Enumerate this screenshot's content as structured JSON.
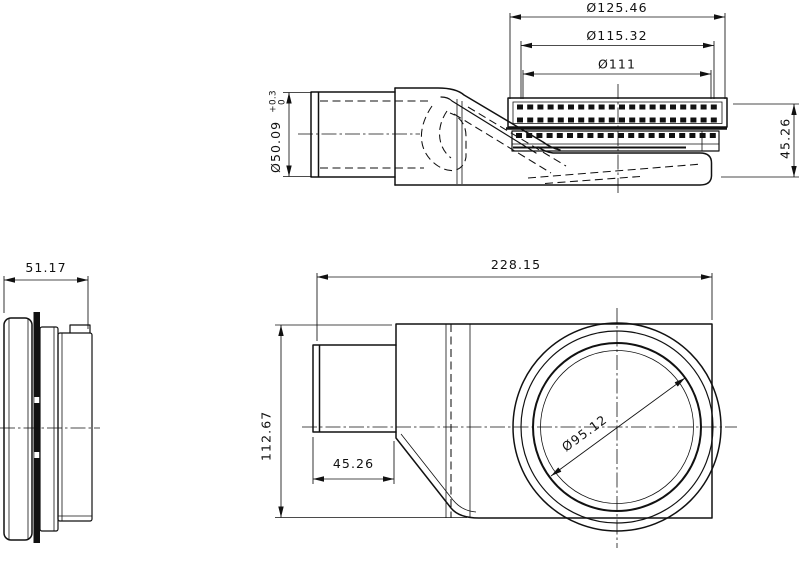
{
  "drawing": {
    "background_color": "#ffffff",
    "line_color": "#111111"
  },
  "side_view": {
    "dim_grate_outer": "Ø125.46",
    "dim_grate_mid": "Ø115.32",
    "dim_grate_inner": "Ø111",
    "dim_inlet_diameter": "Ø50.09",
    "dim_inlet_tol_upper": "+0.3",
    "dim_inlet_tol_lower": "0",
    "dim_height": "45.26"
  },
  "end_view": {
    "dim_depth": "51.17"
  },
  "plan_view": {
    "dim_length": "228.15",
    "dim_width": "112.67",
    "dim_inlet_length": "45.26",
    "dim_sump_diameter": "Ø95.12"
  }
}
